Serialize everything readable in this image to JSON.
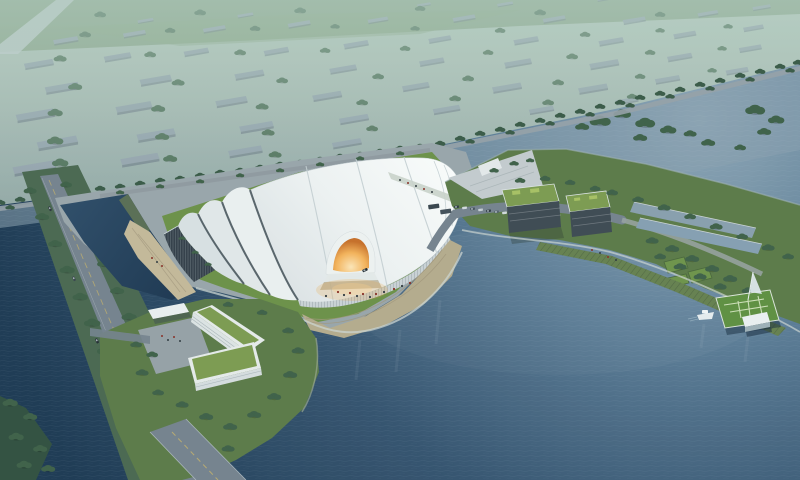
{
  "scene": {
    "type": "aerial-architectural-rendering",
    "setting": "lakefront-exhibition-center-at-dusk",
    "counts": {
      "boats": 1,
      "buses": 2,
      "cars": 12,
      "office_buildings": 2,
      "entrance_portals": 1
    }
  },
  "colors": {
    "city_building": "#95a3ad",
    "city_tree": "#4f7058",
    "field_green": "#7e9a78",
    "water_channel": "#8aa0ae",
    "lake_deep": "#1e3a55",
    "lake_light": "#8fa7b6",
    "boulevard_tree": "#3a5a46",
    "site_tree": "#3f6047",
    "road_gray": "#76838e",
    "road_line_yellow": "#c9b36a",
    "plaza_gray": "#9ba6ab",
    "pier_gray": "#c6cdd0",
    "promenade_sand": "#b7ac8d",
    "beach_sand": "#c6ba9a",
    "lawn_green": "#6d9147",
    "parcel_green": "#5c7a47",
    "slope_green": "#67814f",
    "roof_white": "#f6f8f7",
    "glass_dark": "#333e48",
    "entrance_glow": "#f2a23c",
    "office_wall": "#3e4952",
    "office_roof": "#7d9c50",
    "dock_lawn": "#5f9040",
    "boat_white": "#e9eef0",
    "pavilion_white": "#eef2f3",
    "people_red": "#8a2e24",
    "people_dark": "#30393f"
  }
}
